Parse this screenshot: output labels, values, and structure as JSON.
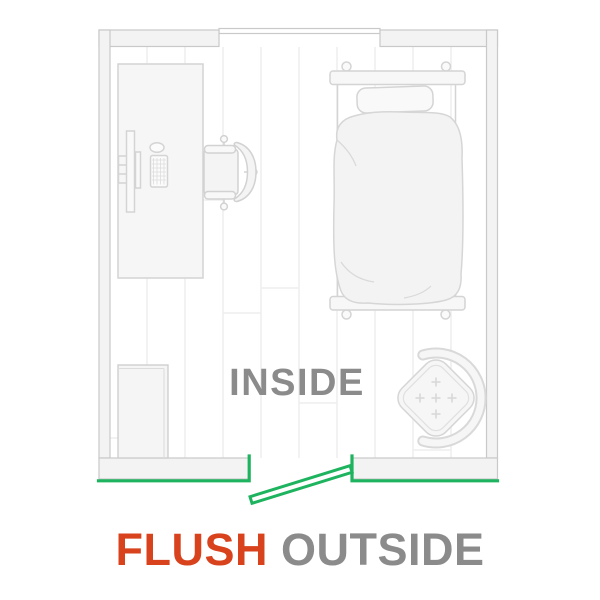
{
  "scene": {
    "type": "floor-plan-illustration",
    "room_label": "INSIDE",
    "caption": {
      "highlight": "FLUSH",
      "rest": "OUTSIDE"
    },
    "colors": {
      "highlight_green": "#1eb45f",
      "flush_red": "#d8421c",
      "label_gray": "#8b8b8b",
      "wall_fill": "#f3f3f3",
      "wall_stroke": "#c9c9c9",
      "furniture_stroke": "#d4d4d4",
      "furniture_fill": "#f6f6f6",
      "floor_plank_line": "#eeeeee"
    },
    "furniture": [
      "desk",
      "monitor",
      "keyboard",
      "mouse",
      "office-chair",
      "bed",
      "pillow",
      "duvet",
      "pouf-ottoman",
      "dresser"
    ],
    "door": {
      "mount": "flush",
      "state": "open-outward"
    }
  }
}
